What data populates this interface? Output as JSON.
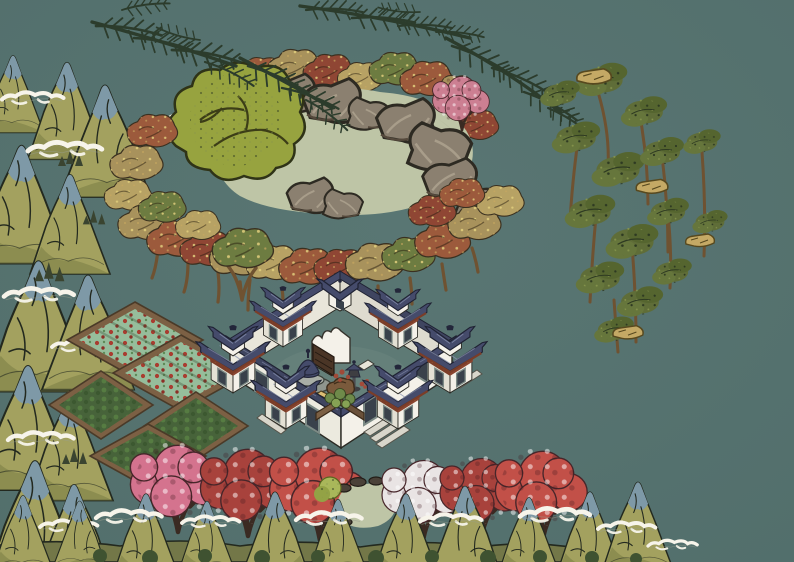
{
  "scene": {
    "title": "Painted Chinese garden estate",
    "style": "ink-and-wash isometric building-game scene, no HUD visible",
    "entities": [
      {
        "id": "courtyard-compound",
        "label": "walled courtyard residence with blue-roofed corner and gate pavilions"
      },
      {
        "id": "inner-court",
        "label": "courtyard with spirit screen, stone altar, stone lantern, bonsai rocks, crate and planter bed"
      },
      {
        "id": "scholar-rock-pond",
        "label": "celadon pond ringed by taihu rocks and autumn trees"
      },
      {
        "id": "olive-canopy-tree",
        "label": "large olive-green tree beside the pond"
      },
      {
        "id": "autumn-tree-belt",
        "label": "belt of tan, rust and green speckled autumn trees"
      },
      {
        "id": "pine-boughs",
        "label": "dark pine boughs sweeping from the top edge"
      },
      {
        "id": "cliff-tree-grove",
        "label": "tall dark-green tree grove with tan rock ledges on the right"
      },
      {
        "id": "farm-plots",
        "label": "five earth-bordered crop plots, two flowering red, three leafy green"
      },
      {
        "id": "blossom-row",
        "label": "row of pink, red, crimson and white blossom trees along the bottom"
      },
      {
        "id": "garden-pondlet",
        "label": "small rock-edged pond with green shrub among the blossoms"
      },
      {
        "id": "mountain-border-left",
        "label": "ink-wash mountain scroll border, left edge"
      },
      {
        "id": "mountain-border-bottom",
        "label": "ink-wash mountain scroll border with cloud swirls, bottom edge"
      }
    ]
  },
  "palette": {
    "background": "#577471",
    "pond_water": "#bec5a6",
    "pond_light": "#ced3b6",
    "rock_grey": "#8b8070",
    "rock_shade": "#6e6354",
    "rock_outline": "#2d2a22",
    "autumn_tan": "#a8925c",
    "autumn_rust": "#9c5a3c",
    "autumn_green": "#6d7c41",
    "autumn_red": "#8f4634",
    "autumn_gold": "#b7a264",
    "speckle_gold": "#e2cf7d",
    "olive_tree": "#97a33f",
    "pine_dark": "#2c3c2c",
    "grove_green": "#5f6d38",
    "grove_light": "#76853f",
    "grove_rock_tan": "#c4a965",
    "trunk_brown": "#6f5231",
    "roof_slate": "#454b6b",
    "roof_sheen": "#8a93b0",
    "roof_dark": "#23263a",
    "beam_brown": "#7b3d28",
    "gold_trim": "#d2a94f",
    "wall_white": "#f4f1e9",
    "wall_shade": "#e3e0d4",
    "door_frame": "#7d8b86",
    "door_dark": "#39414b",
    "step_grey": "#d9d6cb",
    "floor_teal": "#5e7a75",
    "plot_border": "#7c6044",
    "plot_light_green": "#96bd9b",
    "plot_dark_green": "#47633a",
    "berry_red": "#a93c30",
    "blossom_pink": "#d4738e",
    "blossom_red": "#a8423c",
    "blossom_crimson": "#c25048",
    "blossom_white": "#e9e4e4",
    "bush_green": "#a9b75a",
    "mountain_olive": "#a3a15f",
    "mountain_blue": "#7e99a7",
    "mountain_ink": "#23291f",
    "cloud_white": "#f7f4ea",
    "altar_stone": "#a9aea6",
    "lantern_dark": "#3e3e42",
    "crate_tan": "#c9a55c"
  }
}
